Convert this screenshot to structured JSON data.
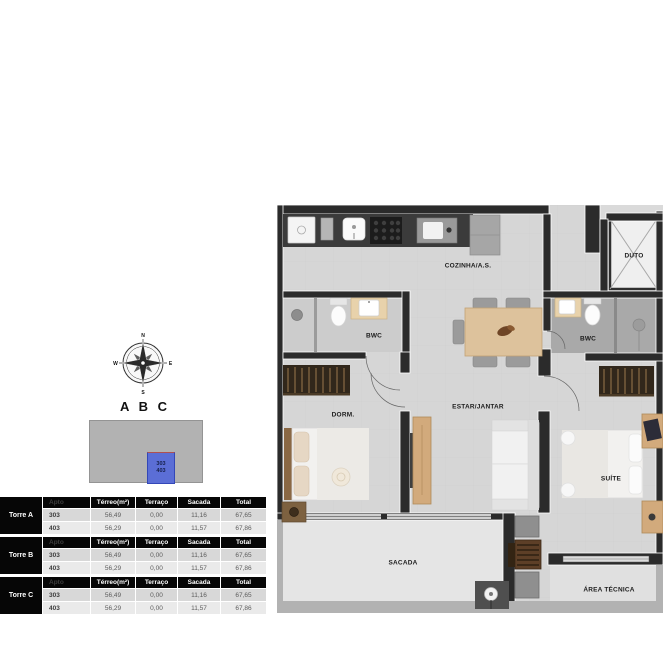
{
  "compass": {
    "north": "N",
    "east": "E",
    "south": "S",
    "west": "W"
  },
  "site_plan": {
    "title": "A B C",
    "unit_line1": "303",
    "unit_line2": "403",
    "highlight_color": "#5b6ed6"
  },
  "tables": {
    "headers": [
      "Apto",
      "Térreo(m²)",
      "Terraço",
      "Sacada",
      "Total"
    ],
    "groups": [
      {
        "name": "Torre A",
        "rows": [
          [
            "303",
            "56,49",
            "0,00",
            "11,16",
            "67,65"
          ],
          [
            "403",
            "56,29",
            "0,00",
            "11,57",
            "67,86"
          ]
        ]
      },
      {
        "name": "Torre B",
        "rows": [
          [
            "303",
            "56,49",
            "0,00",
            "11,16",
            "67,65"
          ],
          [
            "403",
            "56,29",
            "0,00",
            "11,57",
            "67,86"
          ]
        ]
      },
      {
        "name": "Torre C",
        "rows": [
          [
            "303",
            "56,49",
            "0,00",
            "11,16",
            "67,65"
          ],
          [
            "403",
            "56,29",
            "0,00",
            "11,57",
            "67,86"
          ]
        ]
      }
    ]
  },
  "floor_plan": {
    "rooms": {
      "cozinha": "COZINHA/A.S.",
      "duto": "DUTO",
      "bwc_left": "BWC",
      "bwc_right": "BWC",
      "dorm": "DORM.",
      "estar": "ESTAR/JANTAR",
      "suite": "SUÍTE",
      "sacada": "SACADA",
      "area_tecnica": "ÁREA TÉCNICA"
    }
  },
  "colors": {
    "wall": "#2b2b2b",
    "floor": "#d6d6d6",
    "outdoor_wall": "#b2b2b2",
    "accent_blue": "#5b6ed6"
  }
}
